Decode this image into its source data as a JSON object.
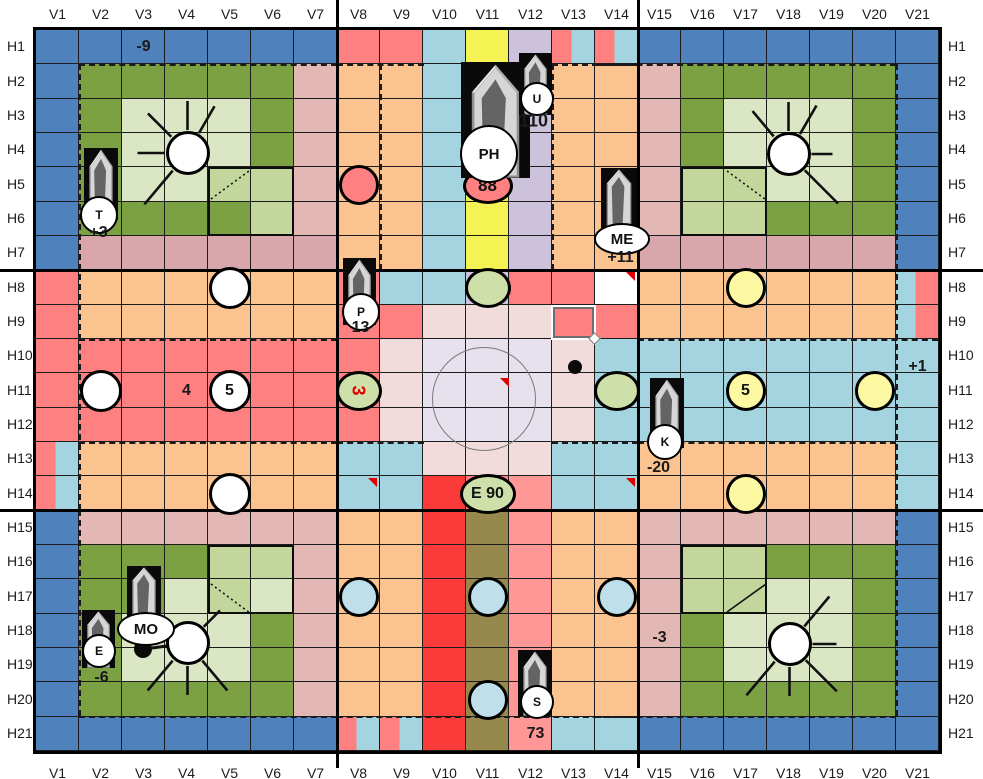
{
  "board": {
    "columns": [
      "V1",
      "V2",
      "V3",
      "V4",
      "V5",
      "V6",
      "V7",
      "V8",
      "V9",
      "V10",
      "V11",
      "V12",
      "V13",
      "V14",
      "V15",
      "V16",
      "V17",
      "V18",
      "V19",
      "V20",
      "V21"
    ],
    "rows": [
      "H1",
      "H2",
      "H3",
      "H4",
      "H5",
      "H6",
      "H7",
      "H8",
      "H9",
      "H10",
      "H11",
      "H12",
      "H13",
      "H14",
      "H15",
      "H16",
      "H17",
      "H18",
      "H19",
      "H20",
      "H21"
    ],
    "palette": {
      "b": "#4f81bd",
      "s": "#ff8080",
      "S": "#ff9797",
      "o": "#fbc38f",
      "m": "#d9a6ab",
      "p": "#e3b7b4",
      "G": "#7ba143",
      "g": "#c3d69b",
      "h": "#dbe6c4",
      "y": "#f5f353",
      "u": "#cdc2db",
      "l": "#a5d4e1",
      "k": "#f2dcdb",
      "v": "#e7e1ed",
      "r": "#fb3a3a",
      "d": "#97894d"
    },
    "split_cells": {
      "1": [
        "s",
        "l"
      ],
      "2": [
        "l",
        "s"
      ]
    },
    "cell_colors": [
      "bbbbbbbsslyu11bbbbbbb",
      "bGGGGGpoolyuoopGGGGGb",
      "bGhhhGpoolyuoopGhhhGb",
      "bGhhhGpoolyuoopGhhhGb",
      "bGhhggpoolyuoopgghhGb",
      "bGGGGgpoolyuoopggGGGb",
      "bmmmmmmoolyuoommmmmmb",
      "sooooooslluss oooooo2",
      "soooooosskkkssoooooo2",
      "sssssssskvvvkllllllll",
      "sssssssskvvvkllllllll",
      "sssssssskvvvkllllllll",
      "1oooooollkkkllooooool",
      "1oooooollrsSllooooool",
      "bppppppoordSooppppppb",
      "bGGGggpoordSoopggGGGb",
      "bGGhghpoordSoopgghhGb",
      "bGhhhGpoordSoopGhhhGb",
      "bGhhhGpoordSoopGhhhGb",
      "bGGGGGpoordSoopGGGGGb",
      "bbbbbbb11rdSllbbbbbbb"
    ],
    "outlined_boxes": [
      {
        "col": 5,
        "row": 5
      },
      {
        "col": 16,
        "row": 5
      },
      {
        "col": 5,
        "row": 16
      },
      {
        "col": 16,
        "row": 16
      }
    ],
    "diagonals": [
      {
        "x1": 211,
        "y1": 199,
        "x2": 249,
        "y2": 171,
        "style": "dotted"
      },
      {
        "x1": 727,
        "y1": 171,
        "x2": 765,
        "y2": 199,
        "style": "dotted"
      },
      {
        "x1": 211,
        "y1": 584,
        "x2": 250,
        "y2": 613,
        "style": "dotted"
      },
      {
        "x1": 727,
        "y1": 612,
        "x2": 766,
        "y2": 584,
        "style": "solid"
      }
    ],
    "dashed_segments": [
      {
        "x": 79,
        "y": 64,
        "w": 258,
        "h": 0
      },
      {
        "x": 596,
        "y": 64,
        "w": 300,
        "h": 0
      },
      {
        "x": 337,
        "y": 64,
        "w": 87,
        "h": 0
      },
      {
        "x": 552,
        "y": 64,
        "w": 86,
        "h": 0
      },
      {
        "x": 79,
        "y": 64,
        "w": 0,
        "h": 446
      },
      {
        "x": 896,
        "y": 64,
        "w": 0,
        "h": 446
      },
      {
        "x": 79,
        "y": 339,
        "w": 258,
        "h": 0
      },
      {
        "x": 638,
        "y": 339,
        "w": 300,
        "h": 0
      },
      {
        "x": 79,
        "y": 442,
        "w": 258,
        "h": 0
      },
      {
        "x": 638,
        "y": 442,
        "w": 258,
        "h": 0
      },
      {
        "x": 79,
        "y": 510,
        "w": 0,
        "h": 206
      },
      {
        "x": 896,
        "y": 510,
        "w": 0,
        "h": 206
      },
      {
        "x": 79,
        "y": 716,
        "w": 258,
        "h": 0
      },
      {
        "x": 596,
        "y": 716,
        "w": 300,
        "h": 0
      },
      {
        "x": 337,
        "y": 716,
        "w": 301,
        "h": 0
      },
      {
        "x": 380,
        "y": 64,
        "w": 0,
        "h": 206
      },
      {
        "x": 552,
        "y": 64,
        "w": 0,
        "h": 206
      },
      {
        "x": 337,
        "y": 442,
        "w": 87,
        "h": 0
      },
      {
        "x": 552,
        "y": 442,
        "w": 86,
        "h": 0
      }
    ]
  },
  "texts": [
    {
      "label": "-9",
      "col": 3,
      "row": 1,
      "dx": 0,
      "dy": 0,
      "size": 16
    },
    {
      "label": "+5",
      "col": 2,
      "row": 4,
      "dx": -8,
      "dy": 6,
      "size": 16,
      "under": true
    },
    {
      "label": "+3",
      "col": 2,
      "row": 6,
      "dx": -2,
      "dy": 14,
      "size": 16
    },
    {
      "label": "110",
      "col": 12,
      "row": 3,
      "dx": 3,
      "dy": 5,
      "size": 18
    },
    {
      "label": "+11",
      "col": 14,
      "row": 7,
      "dx": 4,
      "dy": 5,
      "size": 16
    },
    {
      "label": "13",
      "col": 8,
      "row": 9,
      "dx": 2,
      "dy": 6,
      "size": 16
    },
    {
      "label": "4",
      "col": 4,
      "row": 11,
      "dx": 0,
      "dy": 0,
      "size": 16
    },
    {
      "label": "-20",
      "col": 15,
      "row": 13,
      "dx": -1,
      "dy": 9,
      "size": 16
    },
    {
      "label": "-6",
      "col": 2,
      "row": 19,
      "dx": 1,
      "dy": 13,
      "size": 16
    },
    {
      "label": "-3",
      "col": 15,
      "row": 18,
      "dx": 0,
      "dy": 7,
      "size": 16
    },
    {
      "label": "+1",
      "col": 21,
      "row": 10,
      "dx": 0,
      "dy": 11,
      "size": 16
    },
    {
      "label": "73",
      "col": 12,
      "row": 21,
      "dx": 5,
      "dy": 0,
      "size": 16
    }
  ],
  "pieces": {
    "white_circles": [
      {
        "col": 5,
        "row": 8
      },
      {
        "col": 2,
        "row": 11
      },
      {
        "col": 5,
        "row": 11,
        "label": "5"
      },
      {
        "col": 5,
        "row": 14
      }
    ],
    "salmon_circles": [
      {
        "col": 8,
        "row": 5
      }
    ],
    "yellow_circles": [
      {
        "col": 17,
        "row": 8
      },
      {
        "col": 17,
        "row": 11,
        "label": "5"
      },
      {
        "col": 20,
        "row": 11
      },
      {
        "col": 17,
        "row": 14
      }
    ],
    "green_ellipses": [
      {
        "col": 11,
        "row": 8
      },
      {
        "col": 8,
        "row": 11,
        "label": "3",
        "rot": true
      },
      {
        "col": 14,
        "row": 11
      },
      {
        "col": 11,
        "row": 14,
        "label": "E 90",
        "wide": true
      }
    ],
    "blue_circles": [
      {
        "col": 8,
        "row": 17
      },
      {
        "col": 11,
        "row": 17
      },
      {
        "col": 14,
        "row": 17
      },
      {
        "col": 11,
        "row": 20
      }
    ],
    "red_badges": [
      {
        "col": 11,
        "row": 5,
        "label": "88",
        "dy": 1
      }
    ],
    "colors": {
      "white": "#ffffff",
      "yellow": "#fdf9a2",
      "green": "#cfdfa9",
      "blue": "#bfdfea",
      "salmon": "#ff8080"
    }
  },
  "crystals": [
    {
      "name": "T",
      "rect": [
        84,
        148,
        34,
        72
      ],
      "bubble": {
        "shape": "circle",
        "cx": 97,
        "cy": 213,
        "rx": 17,
        "ry": 17,
        "label": "T"
      }
    },
    {
      "name": "P",
      "rect": [
        343,
        258,
        33,
        67
      ],
      "bubble": {
        "shape": "circle",
        "cx": 359,
        "cy": 310,
        "rx": 17,
        "ry": 17,
        "label": "P"
      }
    },
    {
      "name": "PH",
      "rect": [
        461,
        62,
        69,
        116
      ],
      "bubble": {
        "shape": "circle",
        "cx": 487,
        "cy": 152,
        "rx": 27,
        "ry": 27,
        "label": "PH"
      }
    },
    {
      "name": "U",
      "rect": [
        519,
        53,
        33,
        62
      ],
      "bubble": {
        "shape": "circle",
        "cx": 535,
        "cy": 97,
        "rx": 15,
        "ry": 15,
        "label": "U"
      }
    },
    {
      "name": "ME",
      "rect": [
        601,
        168,
        36,
        60
      ],
      "bubble": {
        "shape": "ellipse",
        "cx": 620,
        "cy": 237,
        "rx": 26,
        "ry": 14,
        "label": "ME"
      }
    },
    {
      "name": "K",
      "rect": [
        650,
        378,
        34,
        70
      ],
      "bubble": {
        "shape": "circle",
        "cx": 663,
        "cy": 440,
        "rx": 16,
        "ry": 16,
        "label": "K"
      }
    },
    {
      "name": "MO",
      "rect": [
        127,
        566,
        34,
        56
      ],
      "bubble": {
        "shape": "ellipse",
        "cx": 144,
        "cy": 627,
        "rx": 27,
        "ry": 15,
        "label": "MO"
      }
    },
    {
      "name": "E",
      "rect": [
        82,
        610,
        33,
        58
      ],
      "bubble": {
        "shape": "circle",
        "cx": 97,
        "cy": 649,
        "rx": 15,
        "ry": 15,
        "label": "E"
      }
    },
    {
      "name": "S",
      "rect": [
        518,
        650,
        34,
        66
      ],
      "bubble": {
        "shape": "circle",
        "cx": 535,
        "cy": 700,
        "rx": 15,
        "ry": 15,
        "label": "S"
      }
    }
  ],
  "suns": [
    {
      "col": 4,
      "row": 4,
      "dx": 1,
      "dy": 3,
      "rays": [
        [
          60,
          32
        ],
        [
          90,
          30
        ],
        [
          135,
          34
        ],
        [
          180,
          28
        ],
        [
          230,
          45
        ]
      ]
    },
    {
      "col": 18,
      "row": 4,
      "dx": 0,
      "dy": 4,
      "rays": [
        [
          60,
          34
        ],
        [
          90,
          30
        ],
        [
          130,
          34
        ],
        [
          0,
          22
        ],
        [
          -45,
          48
        ]
      ]
    },
    {
      "col": 4,
      "row": 18,
      "dx": 1,
      "dy": 12,
      "rays": [
        [
          -50,
          40
        ],
        [
          -90,
          30
        ],
        [
          -130,
          40
        ],
        [
          45,
          24
        ]
      ]
    },
    {
      "col": 18,
      "row": 18,
      "dx": 1,
      "dy": 13,
      "rays": [
        [
          50,
          40
        ],
        [
          0,
          25
        ],
        [
          -130,
          45
        ],
        [
          -90,
          30
        ],
        [
          -45,
          45
        ]
      ]
    }
  ],
  "markers": {
    "black_dots": [
      {
        "x": 575,
        "y": 367,
        "r": 7
      },
      {
        "x": 143,
        "y": 649,
        "r": 9
      }
    ],
    "needle_line": {
      "x1": 152,
      "y1": 648,
      "x2": 174,
      "y2": 645
    },
    "corner_triangles": [
      {
        "col": 14,
        "row": 8
      },
      {
        "col": 8,
        "row": 14
      },
      {
        "col": 14,
        "row": 14
      }
    ],
    "wedge": {
      "x": 500,
      "y": 378
    },
    "selection_square": {
      "x": 553,
      "y": 307,
      "w": 41,
      "h": 31
    },
    "big_circle": {
      "cx": 484,
      "cy": 399,
      "r": 52
    }
  }
}
